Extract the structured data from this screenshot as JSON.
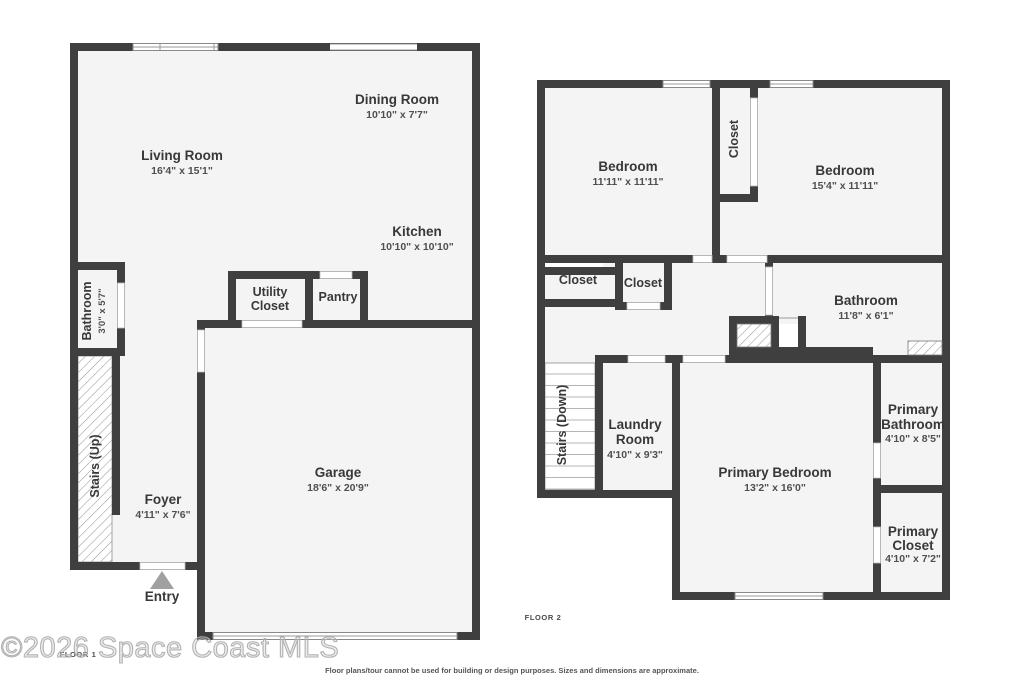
{
  "floor1": {
    "tag": "FLOOR 1",
    "living_room": {
      "name": "Living Room",
      "dims": "16'4\" x 15'1\""
    },
    "dining_room": {
      "name": "Dining Room",
      "dims": "10'10\" x 7'7\""
    },
    "kitchen": {
      "name": "Kitchen",
      "dims": "10'10\" x 10'10\""
    },
    "utility_closet": {
      "line1": "Utility",
      "line2": "Closet"
    },
    "pantry": {
      "name": "Pantry"
    },
    "bathroom": {
      "name": "Bathroom",
      "dims": "3'0\" x 5'7\""
    },
    "stairs": {
      "name": "Stairs (Up)"
    },
    "foyer": {
      "name": "Foyer",
      "dims": "4'11\" x 7'6\""
    },
    "garage": {
      "name": "Garage",
      "dims": "18'6\" x 20'9\""
    },
    "entry": {
      "name": "Entry"
    }
  },
  "floor2": {
    "tag": "FLOOR 2",
    "bedroom_left": {
      "name": "Bedroom",
      "dims": "11'11\" x 11'11\""
    },
    "bedroom_right": {
      "name": "Bedroom",
      "dims": "15'4\" x 11'11\""
    },
    "closet_between_bedrooms": {
      "name": "Closet"
    },
    "hall_closet_left": {
      "name": "Closet"
    },
    "hall_closet_right": {
      "name": "Closet"
    },
    "bathroom": {
      "name": "Bathroom",
      "dims": "11'8\" x 6'1\""
    },
    "stairs": {
      "name": "Stairs (Down)"
    },
    "laundry_room": {
      "line1": "Laundry",
      "line2": "Room",
      "dims": "4'10\" x 9'3\""
    },
    "primary_bedroom": {
      "name": "Primary Bedroom",
      "dims": "13'2\" x 16'0\""
    },
    "primary_bathroom": {
      "line1": "Primary",
      "line2": "Bathroom",
      "dims": "4'10\" x 8'5\""
    },
    "primary_closet": {
      "line1": "Primary",
      "line2": "Closet",
      "dims": "4'10\" x 7'2\""
    }
  },
  "footer": {
    "disclaimer": "Floor plans/tour cannot be used for building or design purposes. Sizes and dimensions are approximate.",
    "watermark": "©2026 Space Coast MLS"
  },
  "colors": {
    "wall": "#3f3f3f",
    "room_fill": "#f4f4f4",
    "room_name_text": "#383838",
    "dimension_text": "#4f4f4f",
    "entry_arrow": "#a0a0a0",
    "hatch_line": "#9a9a9a",
    "window_line": "#8a8a8a"
  }
}
